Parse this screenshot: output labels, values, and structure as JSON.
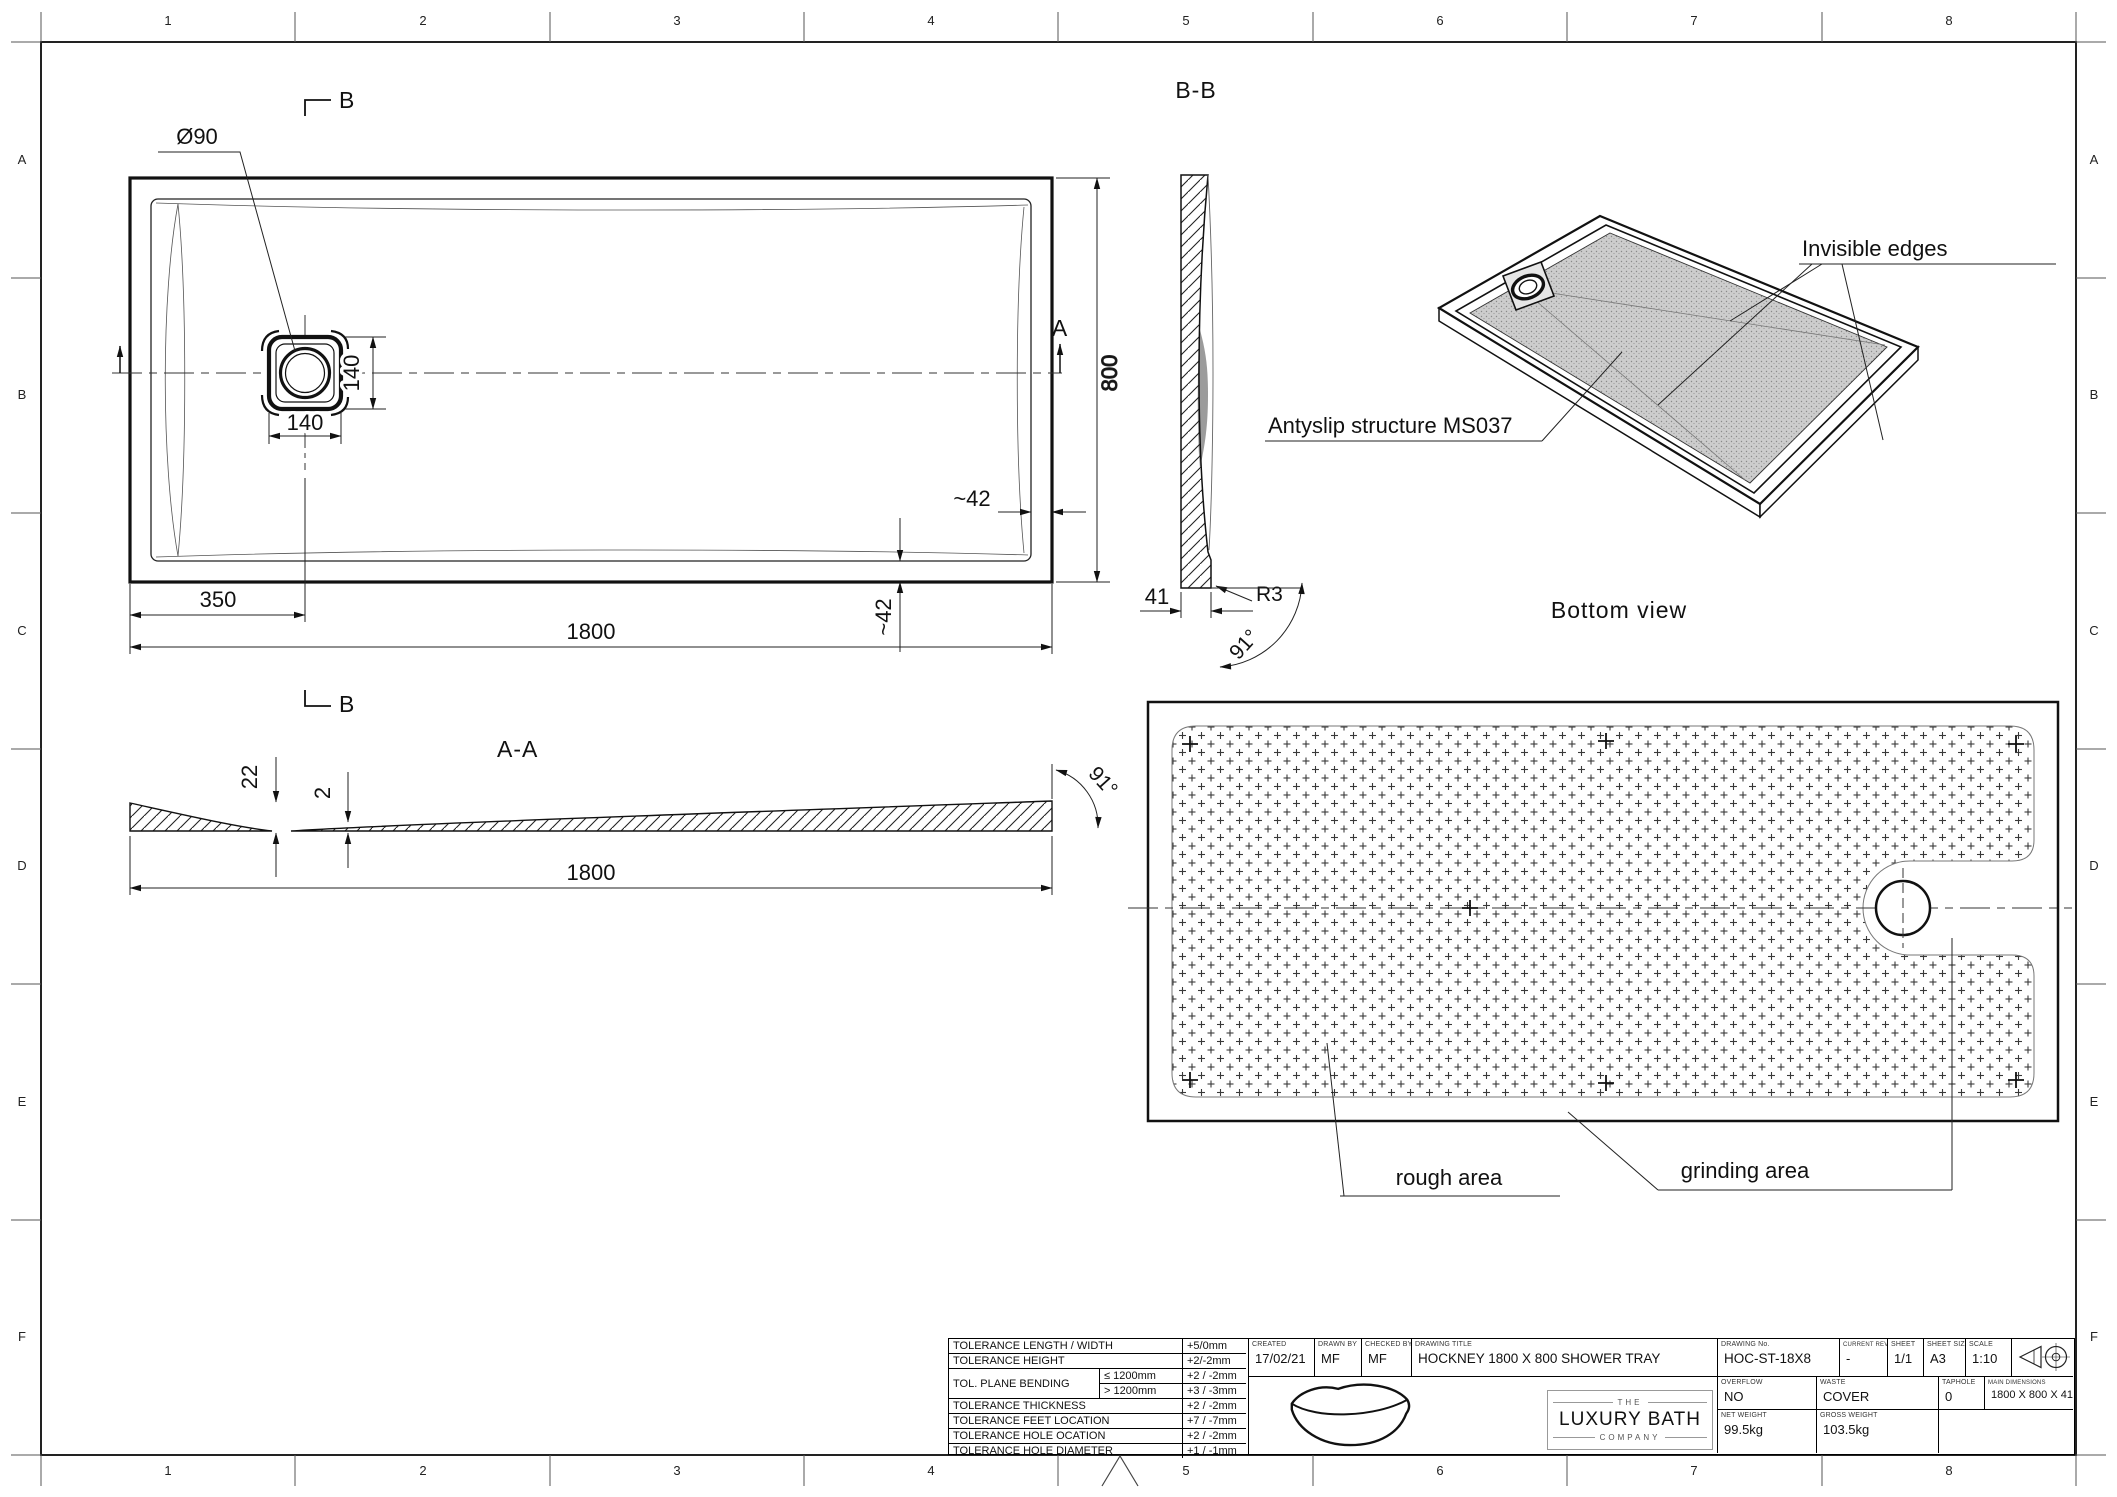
{
  "ink": "#1a1a1a",
  "shade": "#9b9b9b",
  "sheet": {
    "cols": [
      "1",
      "2",
      "3",
      "4",
      "5",
      "6",
      "7",
      "8"
    ],
    "rows": [
      "A",
      "B",
      "C",
      "D",
      "E",
      "F"
    ]
  },
  "top_view": {
    "marker_b_top": "B",
    "marker_b_bottom": "B",
    "marker_a": "A",
    "dim_drain_diameter": "Ø90",
    "dim_drain_width": "140",
    "dim_drain_height": "140",
    "dim_offset": "350",
    "dim_length": "1800",
    "dim_width": "800",
    "dim_rim_right": "~42",
    "dim_rim_bottom": "~42"
  },
  "section_aa": {
    "label": "A-A",
    "dim_edge": "22",
    "dim_mid": "2",
    "dim_length": "1800",
    "dim_angle": "91°"
  },
  "section_bb": {
    "label": "B-B",
    "dim_base": "41",
    "dim_radius": "R3",
    "dim_angle": "91°"
  },
  "iso_view": {
    "label_invisible": "Invisible edges",
    "label_antislip": "Antyslip structure MS037",
    "caption": "Bottom view"
  },
  "bottom_view": {
    "label_rough": "rough area",
    "label_grinding": "grinding area"
  },
  "title_block": {
    "tolerances": [
      {
        "label": "TOLERANCE LENGTH / WIDTH",
        "value": "+5/0mm"
      },
      {
        "label": "TOLERANCE HEIGHT",
        "value": "+2/-2mm"
      },
      {
        "label": "TOL. PLANE BENDING",
        "cond": "≤  1200mm",
        "value": "+2 / -2mm"
      },
      {
        "cond": ">  1200mm",
        "value": "+3 / -3mm"
      },
      {
        "label": "TOLERANCE THICKNESS",
        "value": "+2 / -2mm"
      },
      {
        "label": "TOLERANCE FEET LOCATION",
        "value": "+7 / -7mm"
      },
      {
        "label": "TOLERANCE HOLE OCATION",
        "value": "+2 / -2mm"
      },
      {
        "label": "TOLERANCE HOLE DIAMETER",
        "value": "+1 / -1mm"
      }
    ],
    "created_label": "CREATED",
    "created_value": "17/02/21",
    "drawn_label": "DRAWN BY",
    "drawn_value": "MF",
    "checked_label": "CHECKED BY",
    "checked_value": "MF",
    "title_label": "DRAWING TITLE",
    "title_value": "HOCKNEY 1800 X 800 SHOWER TRAY",
    "number_label": "DRAWING No.",
    "number_value": "HOC-ST-18X8",
    "rev_label": "CURRENT REV.",
    "rev_value": "-",
    "sheet_label": "SHEET",
    "sheet_value": "1/1",
    "size_label": "SHEET SIZE",
    "size_value": "A3",
    "scale_label": "SCALE",
    "scale_value": "1:10",
    "overflow_label": "OVERFLOW",
    "overflow_value": "NO",
    "waste_label": "WASTE",
    "waste_value": "COVER",
    "taphole_label": "TAPHOLE",
    "taphole_value": "0",
    "maindim_label": "MAIN DIMENSIONS",
    "maindim_value": "1800 X 800 X 41",
    "net_label": "NET WEIGHT",
    "net_value": "99.5kg",
    "gross_label": "GROSS WEIGHT",
    "gross_value": "103.5kg",
    "brand_top": "THE",
    "brand_main": "LUXURY BATH",
    "brand_bottom": "COMPANY"
  }
}
